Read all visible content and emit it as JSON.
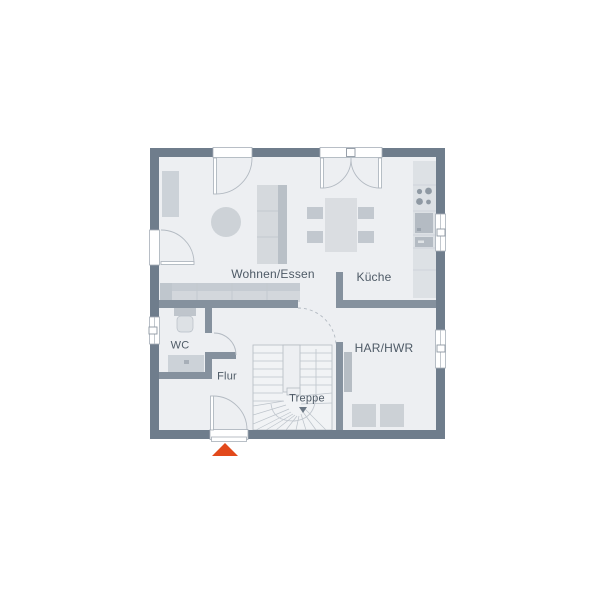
{
  "rooms": {
    "wohnen_essen": "Wohnen/Essen",
    "kueche": "Küche",
    "wc": "WC",
    "flur": "Flur",
    "treppe": "Treppe",
    "har_hwr": "HAR/HWR"
  },
  "markers": {
    "entrance_color": "#e2491b"
  },
  "colors": {
    "outer_wall": "#6f7d8c",
    "inner_wall": "#85919e",
    "floor": "#edeff2",
    "stair_floor": "#f1f3f5",
    "furniture": "#d3d8dd",
    "furniture_dark": "#bcc3ca",
    "label_text": "#4e5a66"
  }
}
